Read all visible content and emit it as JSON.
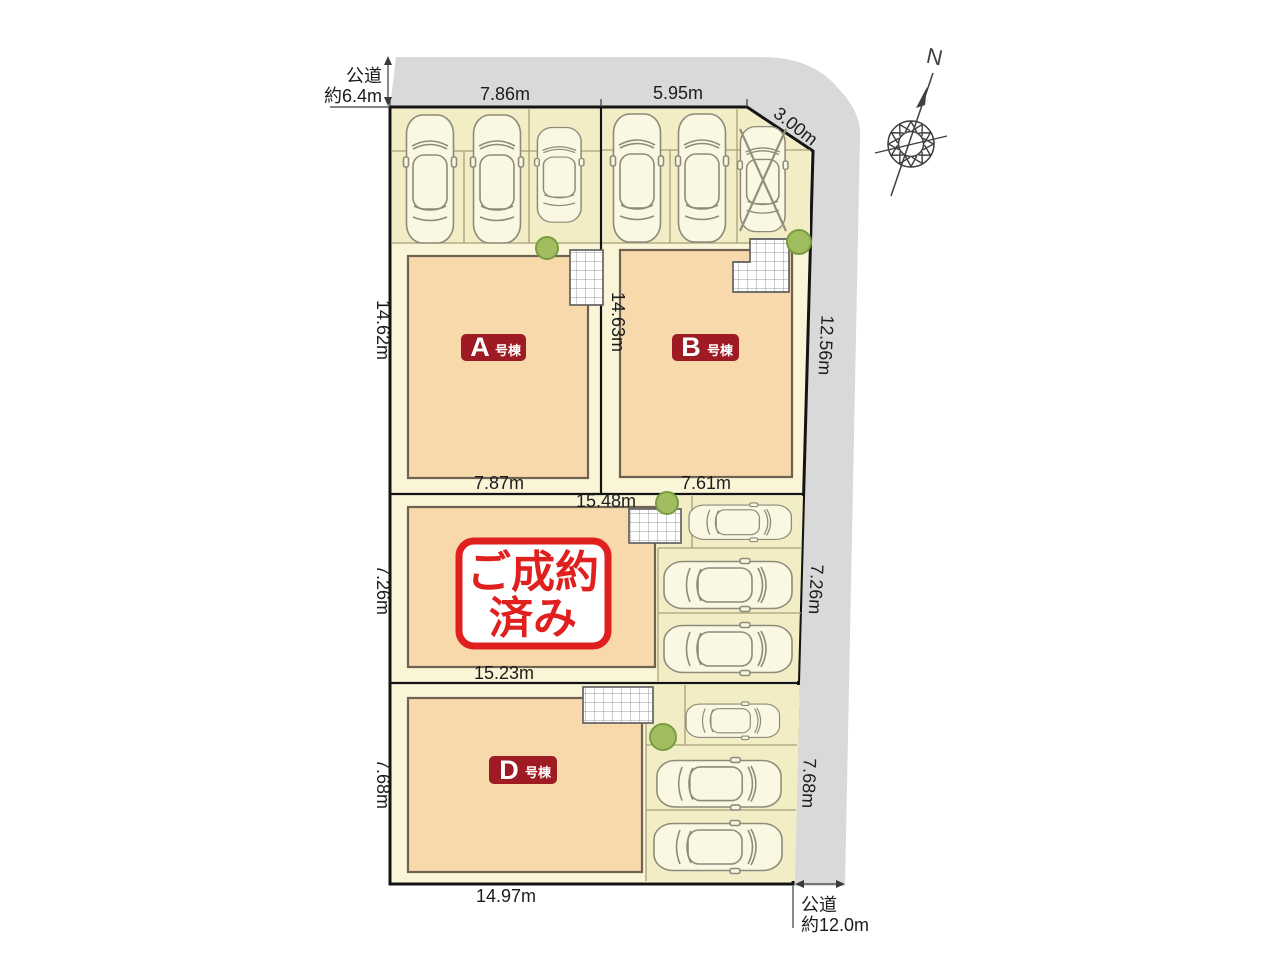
{
  "colors": {
    "road": "#d9d9d9",
    "site_fill": "#f9f5d6",
    "parking_fill": "#f3edc5",
    "building_fill": "#f8d9ab",
    "badge_red": "#9e1b23",
    "stamp_red": "#e01f1f",
    "tree_green": "#a0bd60"
  },
  "compass": {
    "north": "N"
  },
  "roads": {
    "top": {
      "name": "公道",
      "width": "約6.4m"
    },
    "bottom_right": {
      "name": "公道",
      "width": "約12.0m"
    }
  },
  "buildings": {
    "a": {
      "letter": "A",
      "suffix": "号棟"
    },
    "b": {
      "letter": "B",
      "suffix": "号棟"
    },
    "d": {
      "letter": "D",
      "suffix": "号棟"
    },
    "sold": {
      "line1": "ご成約",
      "line2": "済み"
    }
  },
  "dimensions": {
    "top_a": "7.86m",
    "top_b": "5.95m",
    "corner_ne": "3.00m",
    "left_top": "14.62m",
    "center_ab": "14.63m",
    "right_top": "12.56m",
    "a_bottom": "7.87m",
    "b_bottom": "7.61m",
    "mid_top": "15.48m",
    "mid_left": "7.26m",
    "mid_right": "7.26m",
    "mid_bottom": "15.23m",
    "d_left": "7.68m",
    "d_right": "7.68m",
    "d_bottom": "14.97m"
  }
}
